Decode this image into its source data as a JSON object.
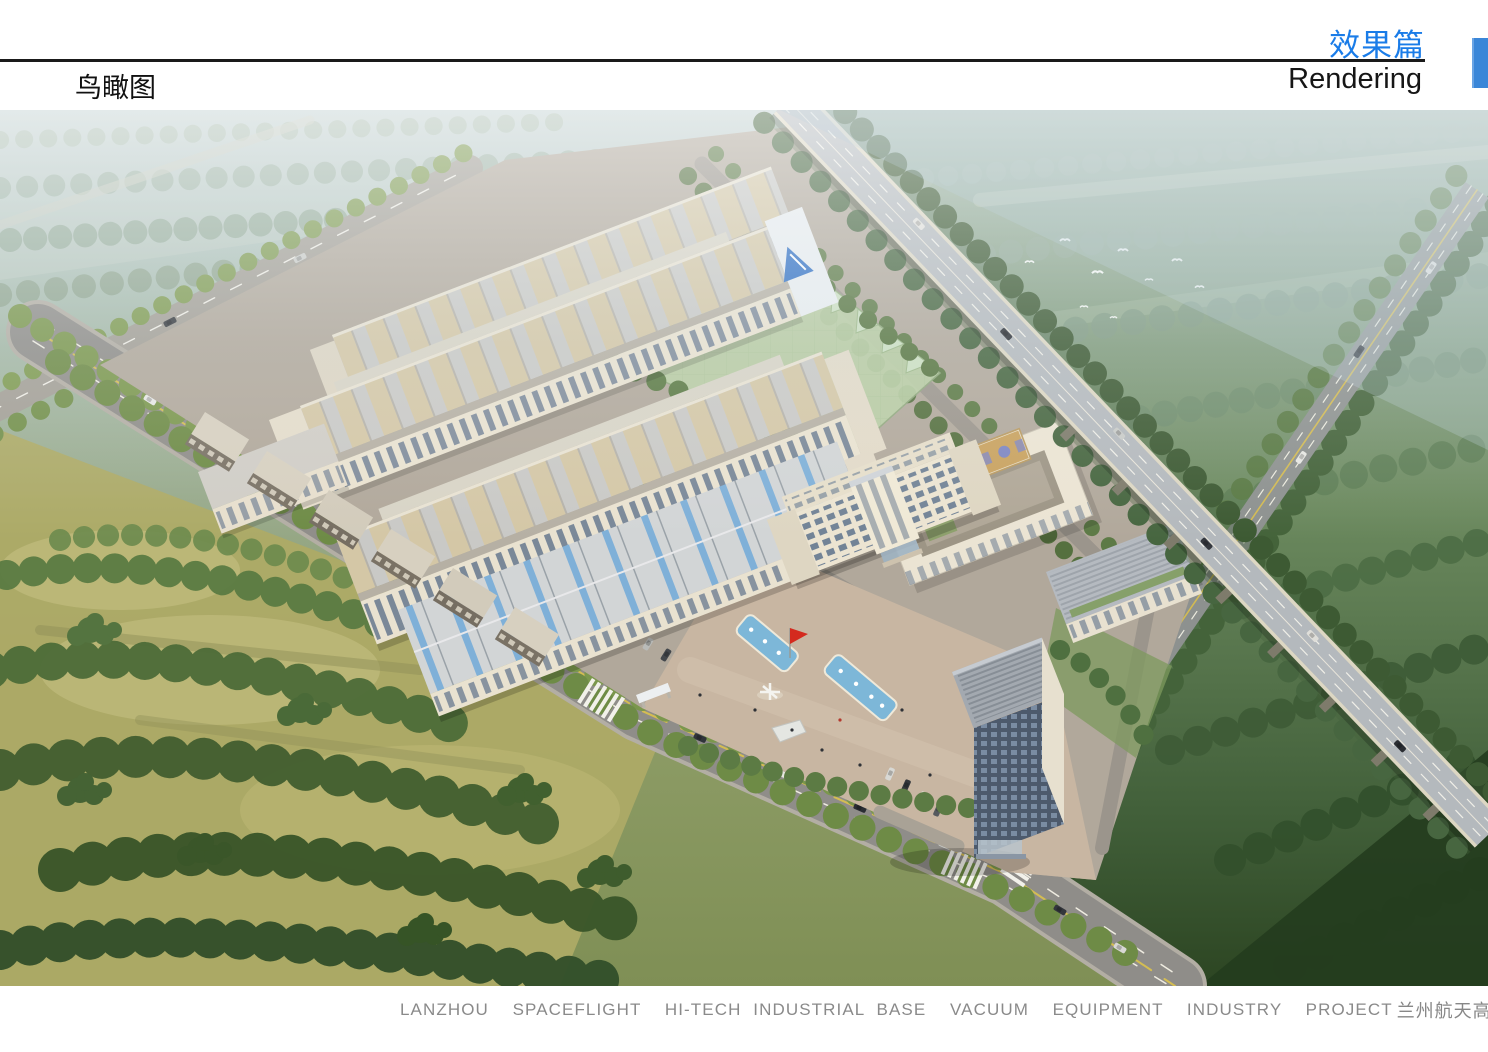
{
  "page": {
    "width": 1488,
    "height": 1052,
    "background": "#ffffff"
  },
  "header": {
    "section_title_cn": "效果篇",
    "section_title_en": "Rendering",
    "page_title_cn": "鸟瞰图",
    "accent_color": "#1a7ce8",
    "rule_color": "#1a1a1a",
    "side_tab_color": "#3a86d8"
  },
  "rendering": {
    "subject": "aerial-birds-eye-rendering-of-industrial-park",
    "palette": {
      "haze_sky": "#c0d2da",
      "distant_green": "#9cb3a6",
      "field_olive": "#adaa66",
      "forest_green": "#4c6c38",
      "dark_forest": "#243c1e",
      "road_gray": "#8f8d89",
      "viaduct_deck": "#b4b9bd",
      "campus_ground": "#b1a89b",
      "plaza_tan": "#c8b6a2",
      "building_cream": "#ece4d1",
      "roof_gray": "#d2d5d6",
      "skylight_tan": "#d4c7a6",
      "skylight_blue": "#7fb0d8",
      "glass_green": "#b9cfa4",
      "pool_blue": "#7db7d8",
      "flag_red": "#d42a1e",
      "logo_blue": "#2f6fc4",
      "lane_yellow": "#d4bd52",
      "court_tan": "#c9a25f",
      "court_blue": "#7e86c2"
    }
  },
  "footer": {
    "caption_en": "LANZHOU  SPACEFLIGHT  HI-TECH INDUSTRIAL BASE  VACUUM  EQUIPMENT  INDUSTRY  PROJECT",
    "caption_cn": "兰州航天高新产业基地真空装备产业园项目",
    "marker_color": "#3f8edd",
    "text_color": "#8a8a8a"
  }
}
